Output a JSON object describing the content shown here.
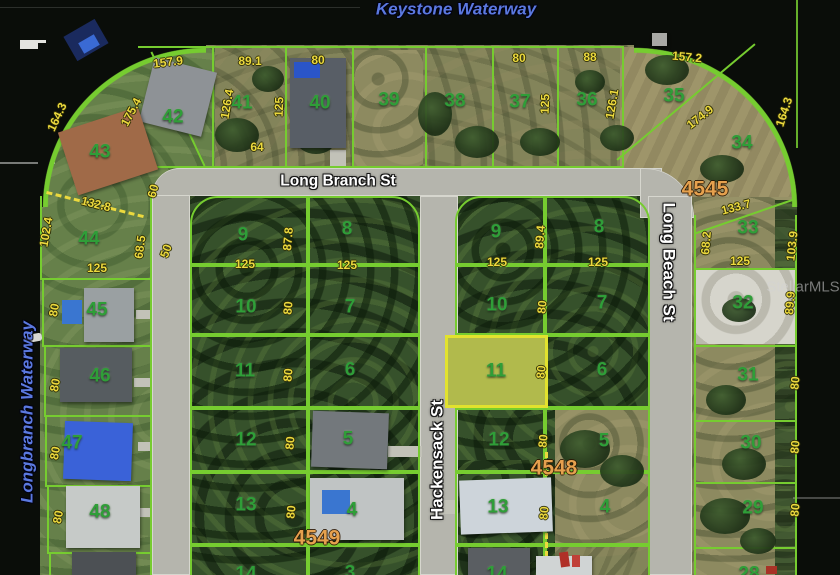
{
  "map": {
    "watermark": "StellarMLS",
    "waterways": {
      "keystone": "Keystone Waterway",
      "longbranch": "Longbranch Waterway"
    },
    "streets": {
      "long_branch": "Long Branch St",
      "hackensack": "Hackensack St",
      "long_beach": "Long Beach St"
    },
    "blocks": [
      "4545",
      "4548",
      "4549"
    ],
    "highlight": {
      "lot": "11",
      "fill": "#e8e846",
      "border": "#e2e22e"
    },
    "colors": {
      "parcel_line": "#76cc30",
      "dimension_text": "#ecd93e",
      "lot_number_text": "#2f9e38",
      "block_number_text": "#e6a14e",
      "water": "#0a0d09"
    },
    "lot_numbers": [
      {
        "t": "42",
        "x": 173,
        "y": 117
      },
      {
        "t": "41",
        "x": 242,
        "y": 103
      },
      {
        "t": "40",
        "x": 320,
        "y": 103
      },
      {
        "t": "39",
        "x": 389,
        "y": 100
      },
      {
        "t": "38",
        "x": 455,
        "y": 101
      },
      {
        "t": "37",
        "x": 520,
        "y": 102
      },
      {
        "t": "36",
        "x": 587,
        "y": 100
      },
      {
        "t": "35",
        "x": 674,
        "y": 96
      },
      {
        "t": "34",
        "x": 742,
        "y": 143
      },
      {
        "t": "33",
        "x": 748,
        "y": 228
      },
      {
        "t": "32",
        "x": 743,
        "y": 303
      },
      {
        "t": "31",
        "x": 748,
        "y": 375
      },
      {
        "t": "30",
        "x": 751,
        "y": 443
      },
      {
        "t": "29",
        "x": 753,
        "y": 508
      },
      {
        "t": "28",
        "x": 749,
        "y": 574
      },
      {
        "t": "43",
        "x": 100,
        "y": 152
      },
      {
        "t": "44",
        "x": 89,
        "y": 239
      },
      {
        "t": "45",
        "x": 97,
        "y": 310
      },
      {
        "t": "46",
        "x": 100,
        "y": 376
      },
      {
        "t": "47",
        "x": 72,
        "y": 443
      },
      {
        "t": "48",
        "x": 100,
        "y": 512
      },
      {
        "t": "9",
        "x": 243,
        "y": 235
      },
      {
        "t": "8",
        "x": 347,
        "y": 229
      },
      {
        "t": "10",
        "x": 246,
        "y": 307
      },
      {
        "t": "7",
        "x": 350,
        "y": 307
      },
      {
        "t": "11",
        "x": 245,
        "y": 371
      },
      {
        "t": "6",
        "x": 350,
        "y": 370
      },
      {
        "t": "12",
        "x": 246,
        "y": 440
      },
      {
        "t": "5",
        "x": 348,
        "y": 439
      },
      {
        "t": "13",
        "x": 246,
        "y": 505
      },
      {
        "t": "4",
        "x": 352,
        "y": 510
      },
      {
        "t": "14",
        "x": 246,
        "y": 574
      },
      {
        "t": "3",
        "x": 350,
        "y": 573
      },
      {
        "t": "9",
        "x": 496,
        "y": 232
      },
      {
        "t": "8",
        "x": 599,
        "y": 227
      },
      {
        "t": "10",
        "x": 497,
        "y": 305
      },
      {
        "t": "7",
        "x": 602,
        "y": 303
      },
      {
        "t": "11",
        "x": 496,
        "y": 371
      },
      {
        "t": "6",
        "x": 602,
        "y": 370
      },
      {
        "t": "12",
        "x": 499,
        "y": 440
      },
      {
        "t": "5",
        "x": 604,
        "y": 441
      },
      {
        "t": "13",
        "x": 498,
        "y": 507
      },
      {
        "t": "4",
        "x": 605,
        "y": 507
      },
      {
        "t": "14",
        "x": 497,
        "y": 574
      }
    ],
    "dimensions": [
      {
        "t": "157.9",
        "x": 168,
        "y": 62,
        "r": -7
      },
      {
        "t": "89.1",
        "x": 250,
        "y": 61,
        "r": 0
      },
      {
        "t": "80",
        "x": 318,
        "y": 60,
        "r": 0
      },
      {
        "t": "126.4",
        "x": 227,
        "y": 104,
        "r": -80
      },
      {
        "t": "125",
        "x": 279,
        "y": 107,
        "r": -88
      },
      {
        "t": "64",
        "x": 257,
        "y": 147,
        "r": 0
      },
      {
        "t": "175.4",
        "x": 131,
        "y": 112,
        "r": -62
      },
      {
        "t": "164.3",
        "x": 57,
        "y": 117,
        "r": -65
      },
      {
        "t": "80",
        "x": 519,
        "y": 58,
        "r": 0
      },
      {
        "t": "88",
        "x": 590,
        "y": 57,
        "r": 0
      },
      {
        "t": "125",
        "x": 545,
        "y": 104,
        "r": -88
      },
      {
        "t": "126.1",
        "x": 612,
        "y": 104,
        "r": -80
      },
      {
        "t": "157.2",
        "x": 687,
        "y": 57,
        "r": 5
      },
      {
        "t": "174.9",
        "x": 700,
        "y": 117,
        "r": -38
      },
      {
        "t": "164.3",
        "x": 784,
        "y": 112,
        "r": -72
      },
      {
        "t": "133.7",
        "x": 736,
        "y": 207,
        "r": -15
      },
      {
        "t": "68.2",
        "x": 706,
        "y": 243,
        "r": -85
      },
      {
        "t": "103.9",
        "x": 792,
        "y": 246,
        "r": -84
      },
      {
        "t": "125",
        "x": 740,
        "y": 261,
        "r": 0
      },
      {
        "t": "89.9",
        "x": 790,
        "y": 303,
        "r": -85
      },
      {
        "t": "80",
        "x": 795,
        "y": 383,
        "r": -85
      },
      {
        "t": "80",
        "x": 795,
        "y": 447,
        "r": -85
      },
      {
        "t": "80",
        "x": 795,
        "y": 510,
        "r": -85
      },
      {
        "t": "132.8",
        "x": 96,
        "y": 204,
        "r": 14
      },
      {
        "t": "102.4",
        "x": 46,
        "y": 232,
        "r": -80
      },
      {
        "t": "68.5",
        "x": 140,
        "y": 247,
        "r": -82
      },
      {
        "t": "60",
        "x": 153,
        "y": 191,
        "r": -75
      },
      {
        "t": "50",
        "x": 166,
        "y": 251,
        "r": -70
      },
      {
        "t": "125",
        "x": 97,
        "y": 268,
        "r": 0
      },
      {
        "t": "80",
        "x": 54,
        "y": 310,
        "r": -80
      },
      {
        "t": "80",
        "x": 55,
        "y": 385,
        "r": -80
      },
      {
        "t": "80",
        "x": 55,
        "y": 453,
        "r": -80
      },
      {
        "t": "80",
        "x": 58,
        "y": 517,
        "r": -80
      },
      {
        "t": "125",
        "x": 245,
        "y": 264,
        "r": 0
      },
      {
        "t": "125",
        "x": 347,
        "y": 265,
        "r": 0
      },
      {
        "t": "87.8",
        "x": 288,
        "y": 239,
        "r": -85
      },
      {
        "t": "80",
        "x": 288,
        "y": 308,
        "r": -85
      },
      {
        "t": "80",
        "x": 288,
        "y": 375,
        "r": -85
      },
      {
        "t": "80",
        "x": 290,
        "y": 443,
        "r": -85
      },
      {
        "t": "80",
        "x": 291,
        "y": 512,
        "r": -85
      },
      {
        "t": "125",
        "x": 497,
        "y": 262,
        "r": 0
      },
      {
        "t": "125",
        "x": 598,
        "y": 262,
        "r": 0
      },
      {
        "t": "89.4",
        "x": 540,
        "y": 237,
        "r": -85
      },
      {
        "t": "80",
        "x": 542,
        "y": 307,
        "r": -85
      },
      {
        "t": "80",
        "x": 541,
        "y": 372,
        "r": -85
      },
      {
        "t": "80",
        "x": 543,
        "y": 441,
        "r": -85
      },
      {
        "t": "80",
        "x": 544,
        "y": 513,
        "r": -85
      }
    ]
  }
}
